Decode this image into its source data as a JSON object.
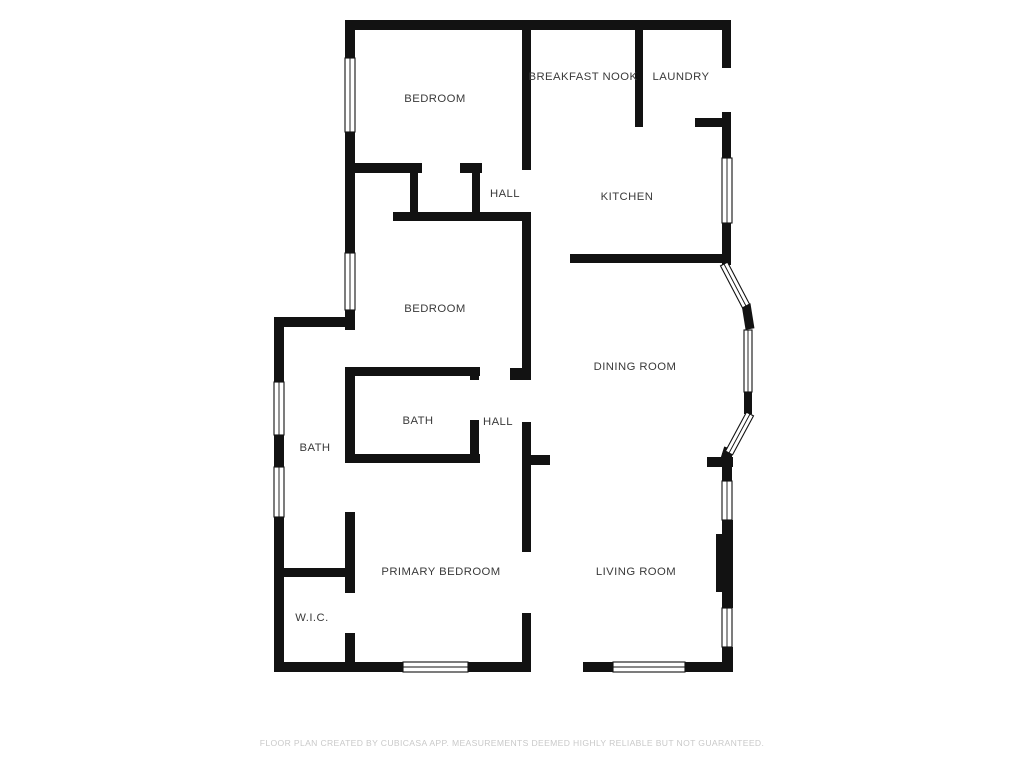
{
  "title": "Floor plan",
  "rooms": [
    {
      "id": "bedroom-top",
      "label": "BEDROOM"
    },
    {
      "id": "breakfast-nook",
      "label": "BREAKFAST NOOK"
    },
    {
      "id": "laundry",
      "label": "LAUNDRY"
    },
    {
      "id": "hall-top",
      "label": "HALL"
    },
    {
      "id": "kitchen",
      "label": "KITCHEN"
    },
    {
      "id": "bedroom-middle",
      "label": "BEDROOM"
    },
    {
      "id": "dining-room",
      "label": "DINING ROOM"
    },
    {
      "id": "bath-middle",
      "label": "BATH"
    },
    {
      "id": "hall-middle",
      "label": "HALL"
    },
    {
      "id": "bath-left",
      "label": "BATH"
    },
    {
      "id": "primary-bedroom",
      "label": "PRIMARY BEDROOM"
    },
    {
      "id": "living-room",
      "label": "LIVING ROOM"
    },
    {
      "id": "wic",
      "label": "W.I.C."
    }
  ],
  "footer": {
    "disclaimer": "FLOOR PLAN CREATED BY CUBICASA APP. MEASUREMENTS DEEMED HIGHLY RELIABLE BUT NOT GUARANTEED."
  },
  "colors": {
    "wall": "#121212",
    "background": "#ffffff",
    "label": "#3a3a3a",
    "footer": "#c9c9c9"
  }
}
